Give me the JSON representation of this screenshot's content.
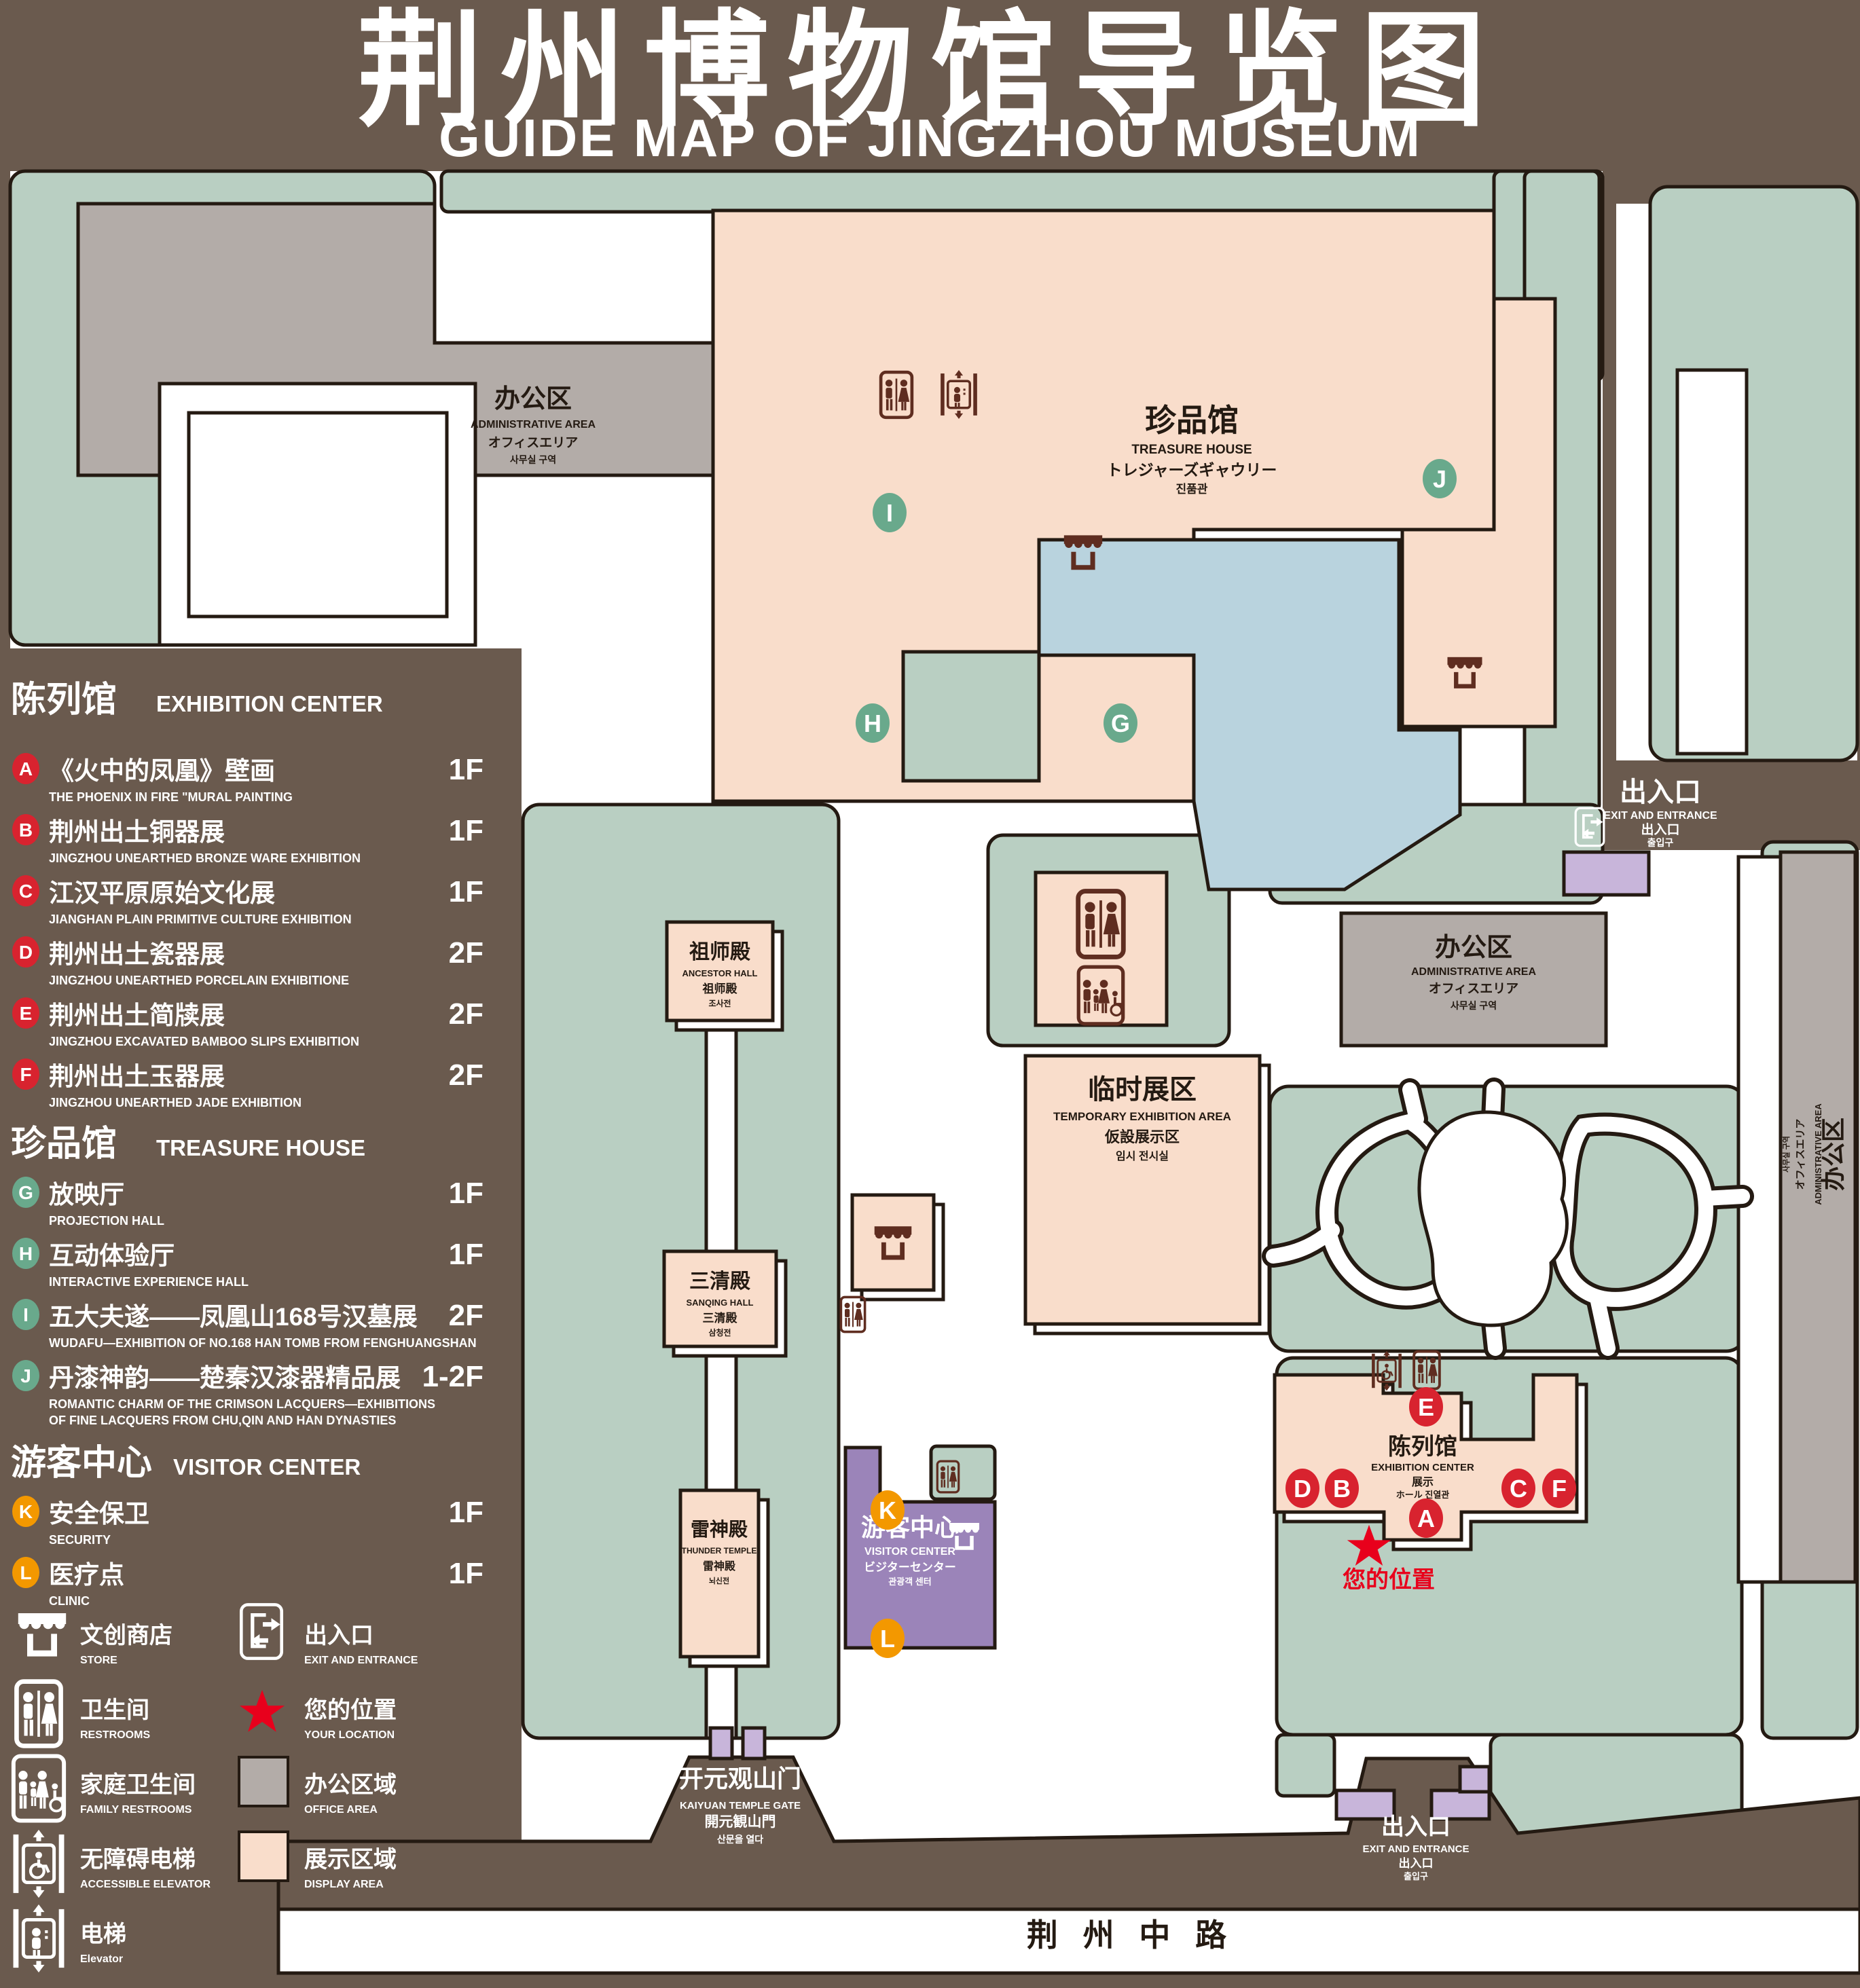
{
  "title": {
    "zh": "荆州博物馆导览图",
    "en": "GUIDE MAP OF JINGZHOU MUSEUM"
  },
  "colors": {
    "background": "#6a5a4e",
    "lawn": "#b9cfc2",
    "display_area": "#f9ddcb",
    "office_area": "#b3aca8",
    "visitor_center": "#9b84b9",
    "light_purple": "#c8b5da",
    "pond": "#b9d3de",
    "badge_red": "#d8232f",
    "badge_green": "#69a98c",
    "badge_orange": "#f39800",
    "icon_maroon": "#5f2d20",
    "location_red": "#e8001c"
  },
  "legend": {
    "sections": [
      {
        "zh": "陈列馆",
        "en": "EXHIBITION CENTER",
        "items": [
          {
            "letter": "A",
            "zh": "《火中的凤凰》壁画",
            "en": "THE PHOENIX IN FIRE \"MURAL PAINTING",
            "floor": "1F"
          },
          {
            "letter": "B",
            "zh": "荆州出土铜器展",
            "en": "JINGZHOU UNEARTHED BRONZE WARE EXHIBITION",
            "floor": "1F"
          },
          {
            "letter": "C",
            "zh": "江汉平原原始文化展",
            "en": "JIANGHAN PLAIN PRIMITIVE CULTURE EXHIBITION",
            "floor": "1F"
          },
          {
            "letter": "D",
            "zh": "荆州出土瓷器展",
            "en": "JINGZHOU UNEARTHED PORCELAIN EXHIBITIONE",
            "floor": "2F"
          },
          {
            "letter": "E",
            "zh": "荆州出土简牍展",
            "en": "JINGZHOU EXCAVATED BAMBOO SLIPS EXHIBITION",
            "floor": "2F"
          },
          {
            "letter": "F",
            "zh": "荆州出土玉器展",
            "en": "JINGZHOU UNEARTHED JADE EXHIBITION",
            "floor": "2F"
          }
        ]
      },
      {
        "zh": "珍品馆",
        "en": "TREASURE HOUSE",
        "items": [
          {
            "letter": "G",
            "zh": "放映厅",
            "en": "PROJECTION HALL",
            "floor": "1F"
          },
          {
            "letter": "H",
            "zh": "互动体验厅",
            "en": "INTERACTIVE EXPERIENCE HALL",
            "floor": "1F"
          },
          {
            "letter": "I",
            "zh": "五大夫遂——凤凰山168号汉墓展",
            "en": "WUDAFU—EXHIBITION OF NO.168 HAN TOMB FROM FENGHUANGSHAN",
            "floor": "2F"
          },
          {
            "letter": "J",
            "zh": "丹漆神韵——楚秦汉漆器精品展",
            "en": "ROMANTIC CHARM OF THE CRIMSON LACQUERS—EXHIBITIONS",
            "en2": "OF FINE LACQUERS FROM CHU,QIN AND HAN DYNASTIES",
            "floor": "1-2F"
          }
        ]
      },
      {
        "zh": "游客中心",
        "en": "VISITOR CENTER",
        "items": [
          {
            "letter": "K",
            "zh": "安全保卫",
            "en": "SECURITY",
            "floor": "1F"
          },
          {
            "letter": "L",
            "zh": "医疗点",
            "en": "CLINIC",
            "floor": "1F"
          }
        ]
      }
    ],
    "symbols": [
      {
        "icon": "store-icon",
        "zh": "文创商店",
        "en": "STORE"
      },
      {
        "icon": "exit-icon",
        "zh": "出入口",
        "en": "EXIT AND ENTRANCE"
      },
      {
        "icon": "restroom-icon",
        "zh": "卫生间",
        "en": "RESTROOMS"
      },
      {
        "icon": "location-star-icon",
        "zh": "您的位置",
        "en": "YOUR LOCATION"
      },
      {
        "icon": "family-restroom-icon",
        "zh": "家庭卫生间",
        "en": "FAMILY RESTROOMS"
      },
      {
        "icon": "office-area-swatch",
        "zh": "办公区域",
        "en": "OFFICE AREA"
      },
      {
        "icon": "accessible-elevator-icon",
        "zh": "无障碍电梯",
        "en": "ACCESSIBLE ELEVATOR"
      },
      {
        "icon": "display-area-swatch",
        "zh": "展示区域",
        "en": "DISPLAY AREA"
      },
      {
        "icon": "elevator-icon",
        "zh": "电梯",
        "en": "Elevator"
      }
    ]
  },
  "map": {
    "admin": {
      "zh": "办公区",
      "en": "ADMINISTRATIVE AREA",
      "ja": "オフィスエリア",
      "ko": "사무실 구역"
    },
    "treasure_house": {
      "zh": "珍品馆",
      "en": "TREASURE HOUSE",
      "ja": "トレジャーズギャウリー",
      "ko": "진품관"
    },
    "ancestor_hall": {
      "zh": "祖师殿",
      "en": "ANCESTOR HALL",
      "ja": "祖师殿",
      "ko": "조사전"
    },
    "sanqing_hall": {
      "zh": "三清殿",
      "en": "SANQING HALL",
      "ja": "三清殿",
      "ko": "삼청전"
    },
    "thunder_temple": {
      "zh": "雷神殿",
      "en": "THUNDER TEMPLE",
      "ja": "雷神殿",
      "ko": "뇌신전"
    },
    "temporary_exhibition": {
      "zh": "临时展区",
      "en": "TEMPORARY EXHIBITION AREA",
      "ja": "仮設展示区",
      "ko": "임시 전시실"
    },
    "visitor_center": {
      "zh": "游客中心",
      "en": "VISITOR CENTER",
      "ja": "ビジターセンター",
      "ko": "관광객 센터"
    },
    "exhibition_center": {
      "zh": "陈列馆",
      "en": "EXHIBITION CENTER",
      "line3": "展示",
      "line4": "ホール 진열관"
    },
    "gate": {
      "zh": "开元观山门",
      "en": "KAIYUAN TEMPLE GATE",
      "ja": "開元観山門",
      "ko": "산문을 열다"
    },
    "exit": {
      "zh": "出入口",
      "en": "EXIT AND ENTRANCE",
      "ja": "出入口",
      "ko": "출입구"
    },
    "your_location": "您的位置",
    "road": "荆 州 中 路"
  }
}
